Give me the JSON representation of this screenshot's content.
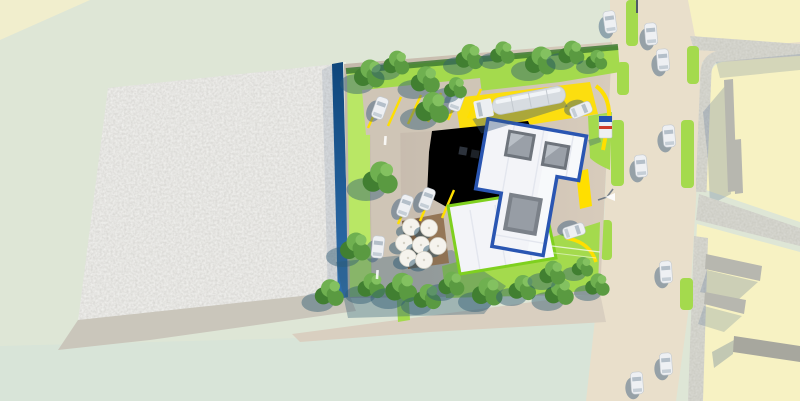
{
  "meta": {
    "title": "Aerial 3D architectural site render",
    "description": "Top-down bird's-eye 3D visualization of a service-station / retail plot: white flat-roof building with blue roof trim and skylights, annex roof with lime-green trim, cafe terrace with white umbrellas, tanker truck on yellow delivery zone, angled parking bays, bright green lawns with trees, dark blue west fence, empty gravel lot at left, vertical street with cars at right and pale-yellow neighbouring blocks with grey sidewalks and walls",
    "sun_direction": "upper-right, shadows cast to lower-left"
  },
  "scene": {
    "site": {
      "label": "service-station plot",
      "main_building": "white roof, blue trim, 2 skylights, central atrium opening",
      "annex_building": "white roof, lime-green trim",
      "terrace_umbrella_count": 7,
      "parking_bay_stripe_count": 9,
      "delivery_truck_count": 1
    },
    "street": {
      "label": "vertical street at right",
      "vehicle_count": 8,
      "green_verge_count": 6
    },
    "surroundings": {
      "gravel_lot": "empty speckled lot at left",
      "neighbour_blocks": "pale yellow plots with grey sidewalks and free-standing walls",
      "tree_count": 23
    }
  },
  "colors": {
    "background_sage": "#dee6d6",
    "corner_yellow": "#f1eecd",
    "bottom_pale": "#d8e4d8",
    "road": "#e9dfcb",
    "plot_yellow": "#f7f2c3",
    "sidewalk": "#c7c7be",
    "wall_gray": "#b7b7af",
    "wall_dark": "#a7a79e",
    "shadow_blue": "#4a688f",
    "gravel": "#d4d3cf",
    "ground_band": "#cac6bb",
    "tan_strip": "#d9cfc0",
    "pavement": "#c3b8ab",
    "pavement_light": "#d8ccbc",
    "driveway": "#cfc5b6",
    "lawn": "#a4da4d",
    "lawn_light": "#b9e765",
    "hedge": "#3e7a33",
    "fence_top": "#0f477c",
    "fence_bottom": "#2f6fae",
    "fence_edge": "#7fa8c9",
    "roof_white": "#f3f4f8",
    "roof_bright": "#fafbfe",
    "roof_ridge": "#e3e6ee",
    "trim_blue": "#2a56b2",
    "trim_lime": "#7fd01f",
    "skylight_frame": "#6e747c",
    "skylight_glass": "#9aa0a8",
    "skylight_glare": "#c3c9d0",
    "atrium_frame": "#7b8189",
    "atrium_glass": "#979da5",
    "deck_brown": "#8e6e4d",
    "deck_dark": "#5d4632",
    "umbrella": "#f5f3ed",
    "umbrella_edge": "#d4d1c6",
    "car_body": "#eef0f3",
    "car_edge": "#c3c9cf",
    "car_glass": "#b4bfc9",
    "car_shadow": "#31567d",
    "truck_tank": "#d7dce1",
    "truck_cab": "#eceff2",
    "truck_high": "#f1f4f7",
    "yellow_marking": "#ffdf00",
    "tree_1": "#5a9a41",
    "tree_2": "#6fb050",
    "tree_3": "#417f31",
    "tree_high": "#83c160",
    "tree_shadow": "#2e5a74",
    "white_marking": "#ffffff",
    "pole_gray": "#4e5a66",
    "lamp_shadow": "#44566b",
    "sign_blue": "#2553b2",
    "sign_red": "#cf3b2a",
    "equip_dark": "#2d333c",
    "equip_darker": "#1d2228"
  }
}
